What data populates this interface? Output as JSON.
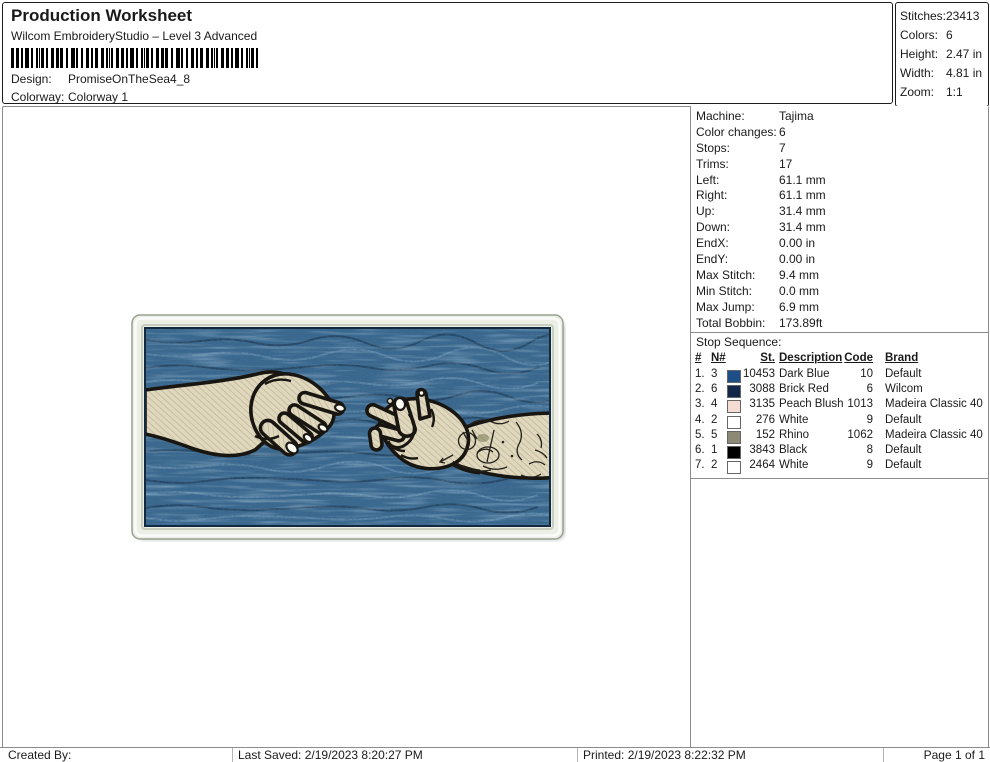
{
  "header": {
    "title": "Production Worksheet",
    "subtitle": "Wilcom EmbroideryStudio – Level 3 Advanced",
    "design_label": "Design:",
    "design_value": "PromiseOnTheSea4_8",
    "colorway_label": "Colorway:",
    "colorway_value": "Colorway 1"
  },
  "summary": {
    "rows": [
      {
        "label": "Stitches:",
        "value": "23413"
      },
      {
        "label": "Colors:",
        "value": "6"
      },
      {
        "label": "Height:",
        "value": "2.47 in"
      },
      {
        "label": "Width:",
        "value": "4.81 in"
      },
      {
        "label": "Zoom:",
        "value": "1:1"
      }
    ]
  },
  "machine_info": {
    "rows": [
      {
        "label": "Machine:",
        "value": "Tajima"
      },
      {
        "label": "Color changes:",
        "value": "6"
      },
      {
        "label": "Stops:",
        "value": "7"
      },
      {
        "label": "Trims:",
        "value": "17"
      },
      {
        "label": "Left:",
        "value": "61.1 mm"
      },
      {
        "label": "Right:",
        "value": "61.1 mm"
      },
      {
        "label": "Up:",
        "value": "31.4 mm"
      },
      {
        "label": "Down:",
        "value": "31.4 mm"
      },
      {
        "label": "EndX:",
        "value": "0.00 in"
      },
      {
        "label": "EndY:",
        "value": "0.00 in"
      },
      {
        "label": "Max Stitch:",
        "value": "9.4 mm"
      },
      {
        "label": "Min Stitch:",
        "value": "0.0 mm"
      },
      {
        "label": "Max Jump:",
        "value": "6.9 mm"
      },
      {
        "label": "Total Bobbin:",
        "value": "173.89ft"
      }
    ]
  },
  "stop_sequence": {
    "title": "Stop Sequence:",
    "columns": {
      "num": "#",
      "needle": "N#",
      "st": "St.",
      "description": "Description",
      "code": "Code",
      "brand": "Brand"
    },
    "rows": [
      {
        "num": "1.",
        "needle": "3",
        "swatch": "#1d4e87",
        "stitches": "10453",
        "description": "Dark Blue",
        "code": "10",
        "brand": "Default"
      },
      {
        "num": "2.",
        "needle": "6",
        "swatch": "#12264a",
        "stitches": "3088",
        "description": "Brick Red",
        "code": "6",
        "brand": "Wilcom"
      },
      {
        "num": "3.",
        "needle": "4",
        "swatch": "#f5dcd2",
        "stitches": "3135",
        "description": "Peach Blush",
        "code": "1013",
        "brand": "Madeira Classic 40"
      },
      {
        "num": "4.",
        "needle": "2",
        "swatch": "#ffffff",
        "stitches": "276",
        "description": "White",
        "code": "9",
        "brand": "Default"
      },
      {
        "num": "5.",
        "needle": "5",
        "swatch": "#8e8877",
        "stitches": "152",
        "description": "Rhino",
        "code": "1062",
        "brand": "Madeira Classic 40"
      },
      {
        "num": "6.",
        "needle": "1",
        "swatch": "#000000",
        "stitches": "3843",
        "description": "Black",
        "code": "8",
        "brand": "Default"
      },
      {
        "num": "7.",
        "needle": "2",
        "swatch": "#ffffff",
        "stitches": "2464",
        "description": "White",
        "code": "9",
        "brand": "Default"
      }
    ]
  },
  "design_preview": {
    "description": "Embroidered rectangular patch: two hands reaching toward each other (tattooed forearm on right) over a mottled dark blue stitched background with cream satin border",
    "colors": {
      "background_blue": "#3a6a92",
      "border_cream": "#ecefe6",
      "skin": "#dfd8bf",
      "outline": "#191611",
      "nails": "#fcfcf4"
    }
  },
  "footer": {
    "created_by": "Created By:",
    "last_saved": "Last Saved: 2/19/2023 8:20:27 PM",
    "printed": "Printed: 2/19/2023 8:22:32 PM",
    "page": "Page 1 of 1"
  }
}
